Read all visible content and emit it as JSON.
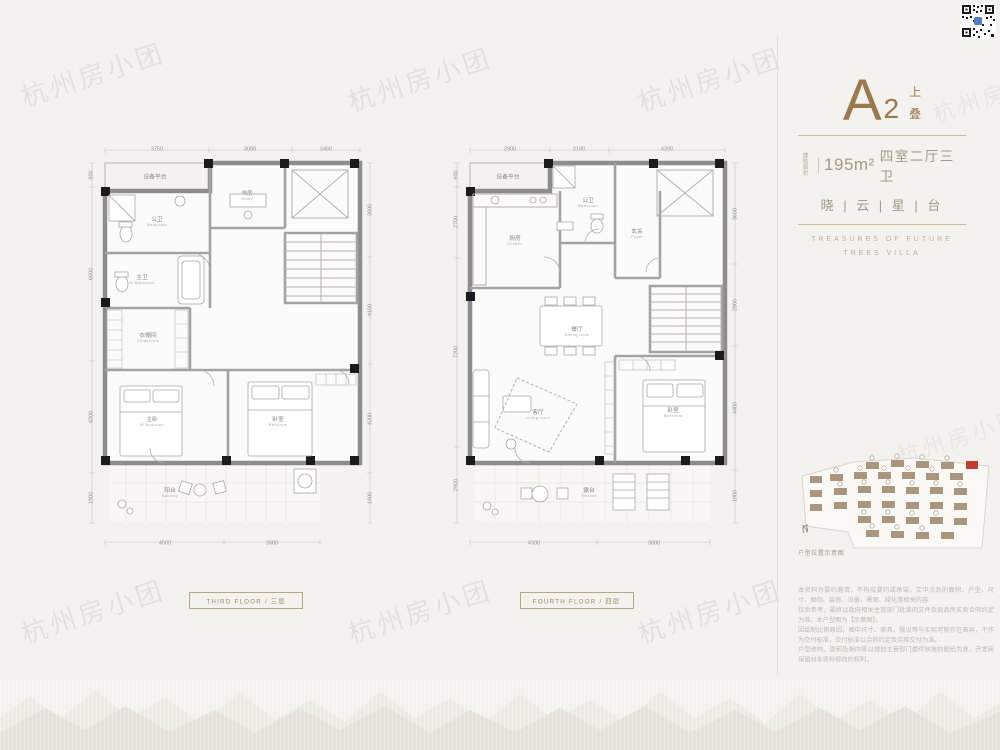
{
  "watermark": {
    "text": "杭州房小团"
  },
  "info_panel": {
    "unit_letter": "A",
    "unit_number": "2",
    "stack_top": "上",
    "stack_bottom": "叠",
    "area_prefix_top": "建筑",
    "area_prefix_bottom": "面积",
    "area_value": "195m²",
    "room_layout": "四室二厅三卫",
    "slogan": "晓 | 云 | 星 | 台",
    "tagline_line1": "TREASURES OF FUTURE",
    "tagline_line2": "TREES VILLA",
    "accent_color": "#9a7a4c"
  },
  "siteplan": {
    "north_label": "N",
    "caption": "户型位置示意图",
    "block_color": "#a28b70",
    "highlight_color": "#c63c33"
  },
  "disclaimer": {
    "lines": [
      "本资料为要约邀请，不构成要约或承诺，文中涉及的面积、户型、尺寸、图例、装修、设备、景观、绿化等相关内容",
      "仅供参考，最终以政府相关主管部门批准的文件及商品房买卖合同约定为准。本户型图为【示意图】，",
      "因绘制比例原因，图中尺寸、家具、摆设等与实际可能存在差异，不作为交付标准，交付标准以合同约定及实际交付为准。",
      "户型结构、面积及朝向等以规划主管部门最终核准的图纸为准，开发商保留对本资料修改的权利。",
      "本资料对项目周边环境、交通、教育及其他配套设施的介绍，旨在提供相关信息，不代表对此作出承诺。",
      "买受人应以自身查勘及政府相关文件为准，一切信息最终以政府批文及双方签订的商品房买卖合同为准。",
      "本项目推广名为【晓云星台】，备案名以相关部门核准为准。图片及文字如有侵权，请联系删除。",
      "本资料制作时间为出街当日，敬请留意最新资料，开发商在法律允许范围内保留最终解释权。"
    ]
  },
  "floorplans": [
    {
      "id": "f3",
      "label_en": "THIRD FLOOR",
      "label_sep": "/",
      "label_cn": "三层",
      "rooms": [
        {
          "name": "设备平台",
          "en": "",
          "x": 25,
          "y": 9
        },
        {
          "name": "书房",
          "en": "Study",
          "x": 55.8,
          "y": 13.4
        },
        {
          "name": "公卫",
          "en": "Bathroom",
          "x": 25.8,
          "y": 19.5
        },
        {
          "name": "主卫",
          "en": "M·Bathroom",
          "x": 20.5,
          "y": 33.1
        },
        {
          "name": "衣帽间",
          "en": "Cloakroom",
          "x": 22.5,
          "y": 46.5
        },
        {
          "name": "主卧",
          "en": "M·Bedroom",
          "x": 24,
          "y": 66
        },
        {
          "name": "卧室",
          "en": "Bedroom",
          "x": 66,
          "y": 66
        },
        {
          "name": "阳台",
          "en": "Balcony",
          "x": 30,
          "y": 82.5
        }
      ],
      "dims": [
        {
          "t": "3750",
          "x": 25.7,
          "y": 2.6
        },
        {
          "t": "3000",
          "x": 56.8,
          "y": 2.6
        },
        {
          "t": "2450",
          "x": 82,
          "y": 2.6
        },
        {
          "t": "900",
          "x": 3.5,
          "y": 8.6,
          "v": true
        },
        {
          "t": "6600",
          "x": 3.5,
          "y": 31.7,
          "v": true
        },
        {
          "t": "4200",
          "x": 3.5,
          "y": 64.9,
          "v": true
        },
        {
          "t": "1900",
          "x": 3.5,
          "y": 83.7,
          "v": true
        },
        {
          "t": "3600",
          "x": 96.8,
          "y": 16.7,
          "v": true
        },
        {
          "t": "4100",
          "x": 96.8,
          "y": 40.1,
          "v": true
        },
        {
          "t": "4200",
          "x": 96.8,
          "y": 65.3,
          "v": true
        },
        {
          "t": "1900",
          "x": 96.8,
          "y": 83.8,
          "v": true
        },
        {
          "t": "4500",
          "x": 28.2,
          "y": 94.3
        },
        {
          "t": "3600",
          "x": 64,
          "y": 94.3
        }
      ]
    },
    {
      "id": "f4",
      "label_en": "FOURTH FLOOR",
      "label_sep": "/",
      "label_cn": "四层",
      "rooms": [
        {
          "name": "设备平台",
          "en": "",
          "x": 21,
          "y": 9
        },
        {
          "name": "厨房",
          "en": "Kitchen",
          "x": 23.3,
          "y": 24
        },
        {
          "name": "公卫",
          "en": "Bathroom",
          "x": 47.5,
          "y": 15.1
        },
        {
          "name": "玄关",
          "en": "Foyer",
          "x": 64,
          "y": 22.4
        },
        {
          "name": "餐厅",
          "en": "Dining room",
          "x": 44,
          "y": 45
        },
        {
          "name": "客厅",
          "en": "Living room",
          "x": 31,
          "y": 64.5
        },
        {
          "name": "卧室",
          "en": "Bedroom",
          "x": 76,
          "y": 64
        },
        {
          "name": "露台",
          "en": "Terrace",
          "x": 48,
          "y": 82.5
        }
      ],
      "dims": [
        {
          "t": "2900",
          "x": 21.7,
          "y": 2.6
        },
        {
          "t": "2100",
          "x": 44.8,
          "y": 2.6
        },
        {
          "t": "4200",
          "x": 73.9,
          "y": 2.6
        },
        {
          "t": "900",
          "x": 3.5,
          "y": 8.6,
          "v": true
        },
        {
          "t": "2700",
          "x": 3.5,
          "y": 19.6,
          "v": true
        },
        {
          "t": "7200",
          "x": 3.5,
          "y": 49.8,
          "v": true
        },
        {
          "t": "2900",
          "x": 3.5,
          "y": 80.7,
          "v": true
        },
        {
          "t": "3600",
          "x": 96.8,
          "y": 17.6,
          "v": true
        },
        {
          "t": "2900",
          "x": 96.8,
          "y": 38.8,
          "v": true
        },
        {
          "t": "4400",
          "x": 96.8,
          "y": 62.7,
          "v": true
        },
        {
          "t": "1900",
          "x": 96.8,
          "y": 83.3,
          "v": true
        },
        {
          "t": "4300",
          "x": 29.6,
          "y": 94.3
        },
        {
          "t": "3800",
          "x": 69.6,
          "y": 94.3
        }
      ]
    }
  ],
  "colors": {
    "background": "#f3f2ef",
    "wall": "#8d8d8d",
    "column": "#1b1b1b",
    "accent_gold": "#9a7a4c",
    "warm_text": "#a59884"
  }
}
